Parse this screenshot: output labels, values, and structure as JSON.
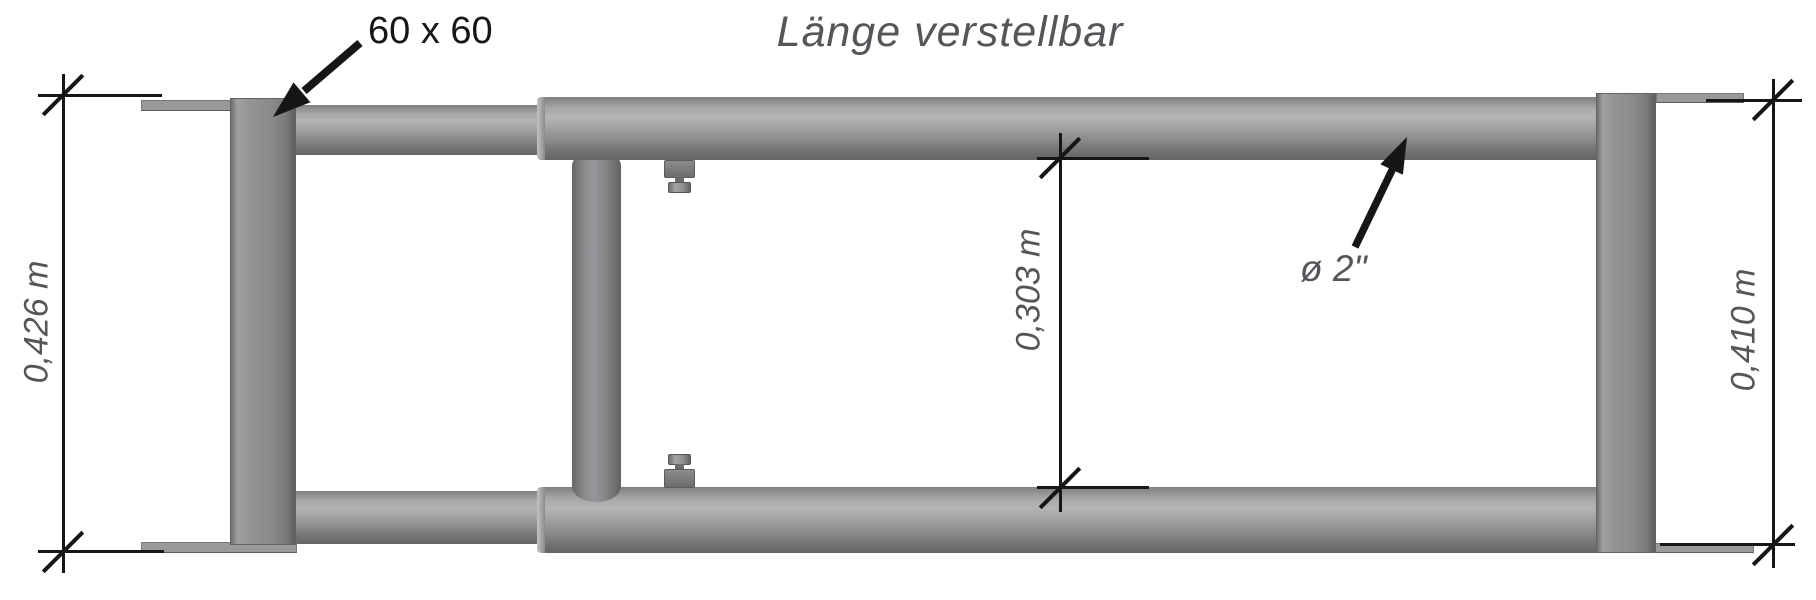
{
  "title": "Länge verstellbar",
  "annotations": {
    "post_size_label": "60 x 60",
    "tube_diameter_label": "ø 2\""
  },
  "dimensions": {
    "left": "0,426 m",
    "middle": "0,303 m",
    "right": "0,410 m"
  },
  "colors": {
    "background": "#ffffff",
    "linework": "#161616",
    "label_text": "#54565a",
    "steel_light": "#b3b4b6",
    "steel_mid": "#8b8c8e",
    "steel_dark": "#606163"
  }
}
